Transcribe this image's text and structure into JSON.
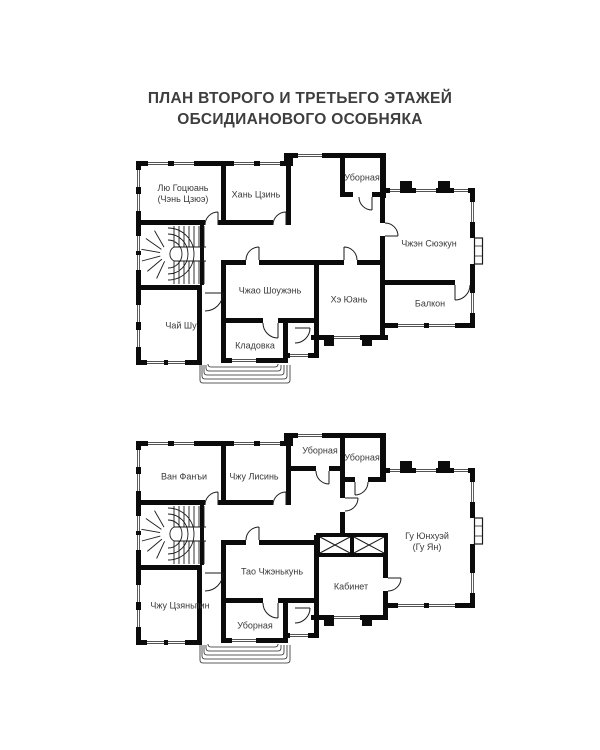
{
  "title": {
    "line1": "ПЛАН ВТОРОГО И ТРЕТЬЕГО ЭТАЖЕЙ",
    "line2": "ОБСИДИАНОВОГО ОСОБНЯКА"
  },
  "floor2": {
    "rooms": {
      "lyu": "Лю Гоцюань (Чэнь Цзюэ)",
      "khan": "Хань Цзинь",
      "ubornaya": "Уборная",
      "chzhen": "Чжэн Сюэкун",
      "chzhao": "Чжао Шоужэнь",
      "khe": "Хэ Юань",
      "balkon": "Балкон",
      "chai": "Чай Шу",
      "kladovka": "Кладовка"
    }
  },
  "floor3": {
    "rooms": {
      "van": "Ван Фанъи",
      "lisin": "Чжу Лисинь",
      "ub1": "Уборная",
      "ub2": "Уборная",
      "gu": "Гу Юнхуэй (Гу Ян)",
      "tao": "Тао Чжэнькунь",
      "kabinet": "Кабинет",
      "tszyanpin": "Чжу Цзяньпин",
      "ub3": "Уборная"
    }
  },
  "colors": {
    "background": "#ffffff",
    "wall": "#0b0b0b",
    "thin_line": "#1a1a1a",
    "label_text": "#3a3a3a",
    "title_text": "#3e3e3e"
  }
}
